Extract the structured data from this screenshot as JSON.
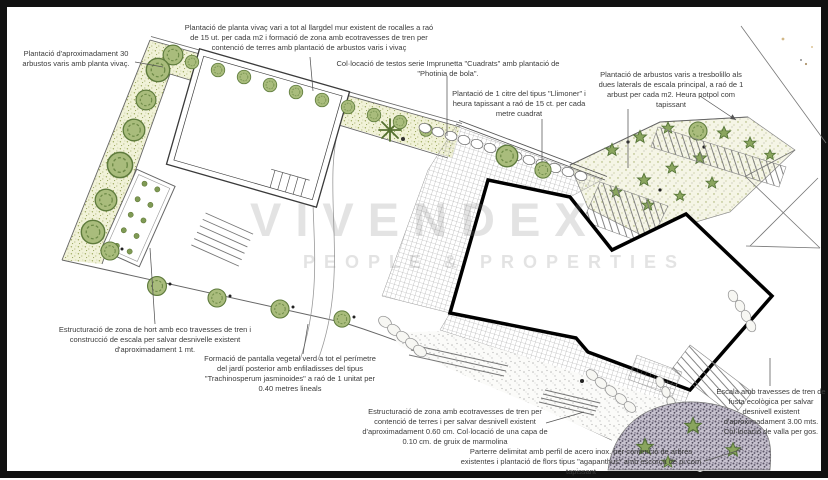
{
  "watermark": {
    "brand": "VIVENDEX",
    "tagline": "PEOPLE & PROPERTIES"
  },
  "annotations": [
    {
      "id": "arbustos-30",
      "text": "Plantació d'aproximadament 30 arbustos varis amb planta vivaç."
    },
    {
      "id": "planta-vivac-mur",
      "text": "Plantació de planta vivaç vari a tot al llargdel mur existent de rocalles a raó de 15 ut. per cada m2 i formació de zona amb ecotravesses de tren per contenció de terres amb plantació de arbustos varis i vivaç"
    },
    {
      "id": "testos-imprunetta",
      "text": "Col·locació de testos serie Imprunetta \"Cuadrats\" amb plantació de \"Photinia de bola\"."
    },
    {
      "id": "llimoner",
      "text": "Plantació de 1 citre del tipus \"Llimoner\" i heura tapissant a raó de 15 ct. per cada metre cuadrat"
    },
    {
      "id": "arbustos-tresbolillo",
      "text": "Plantació de arbustos varis a tresbolillo als dues laterals de escala principal, a raó de 1 arbust per cada m2. Heura potpol com tapissant"
    },
    {
      "id": "escala-fusta-ecologica",
      "text": "Escala amb travesses de tren de fusta ecològica per salvar desnivell existent d'aproximadament 3.00 mts. Col·locació de valla per gos."
    },
    {
      "id": "zona-hort",
      "text": "Estructuració de zona de hort amb eco travesses de tren i construcció de escala per salvar desnivelle existent d'aproximadament 1 mt."
    },
    {
      "id": "pantalla-vegetal",
      "text": "Formació de pantalla vegetal verd a tot el perímetre del jardí posterior amb enfiladisses del tipus \"Trachinosperum jasminoides\" a raó de 1 unitat per 0.40 metres lineals"
    },
    {
      "id": "ecotravesses-marmolina",
      "text": "Estructuració de zona amb ecotravesses de tren per contenció de terres i per salvar desnivell existent d'aproximadament 0.60 cm. Col·locació de una capa de 0.10 cm. de gruix de marmolina"
    },
    {
      "id": "parterre-acer-inox",
      "text": "Parterre delimitat amb perfil de acero inox. per contenció de arbres existentes i plantació de flors tipus \"agapanthus\" amb escorça de pi com tapissant"
    }
  ],
  "palette": {
    "planting_bed": "#f1f2d8",
    "tree_green": "#a9bc7c",
    "tree_outline": "#5e7b3c",
    "paving_hatch": "#9a9a9a",
    "building_outline": "#000000",
    "parterre_fill": "#c7c2cf",
    "gravel_dot": "#bbbbbb",
    "frame": "#111111"
  }
}
